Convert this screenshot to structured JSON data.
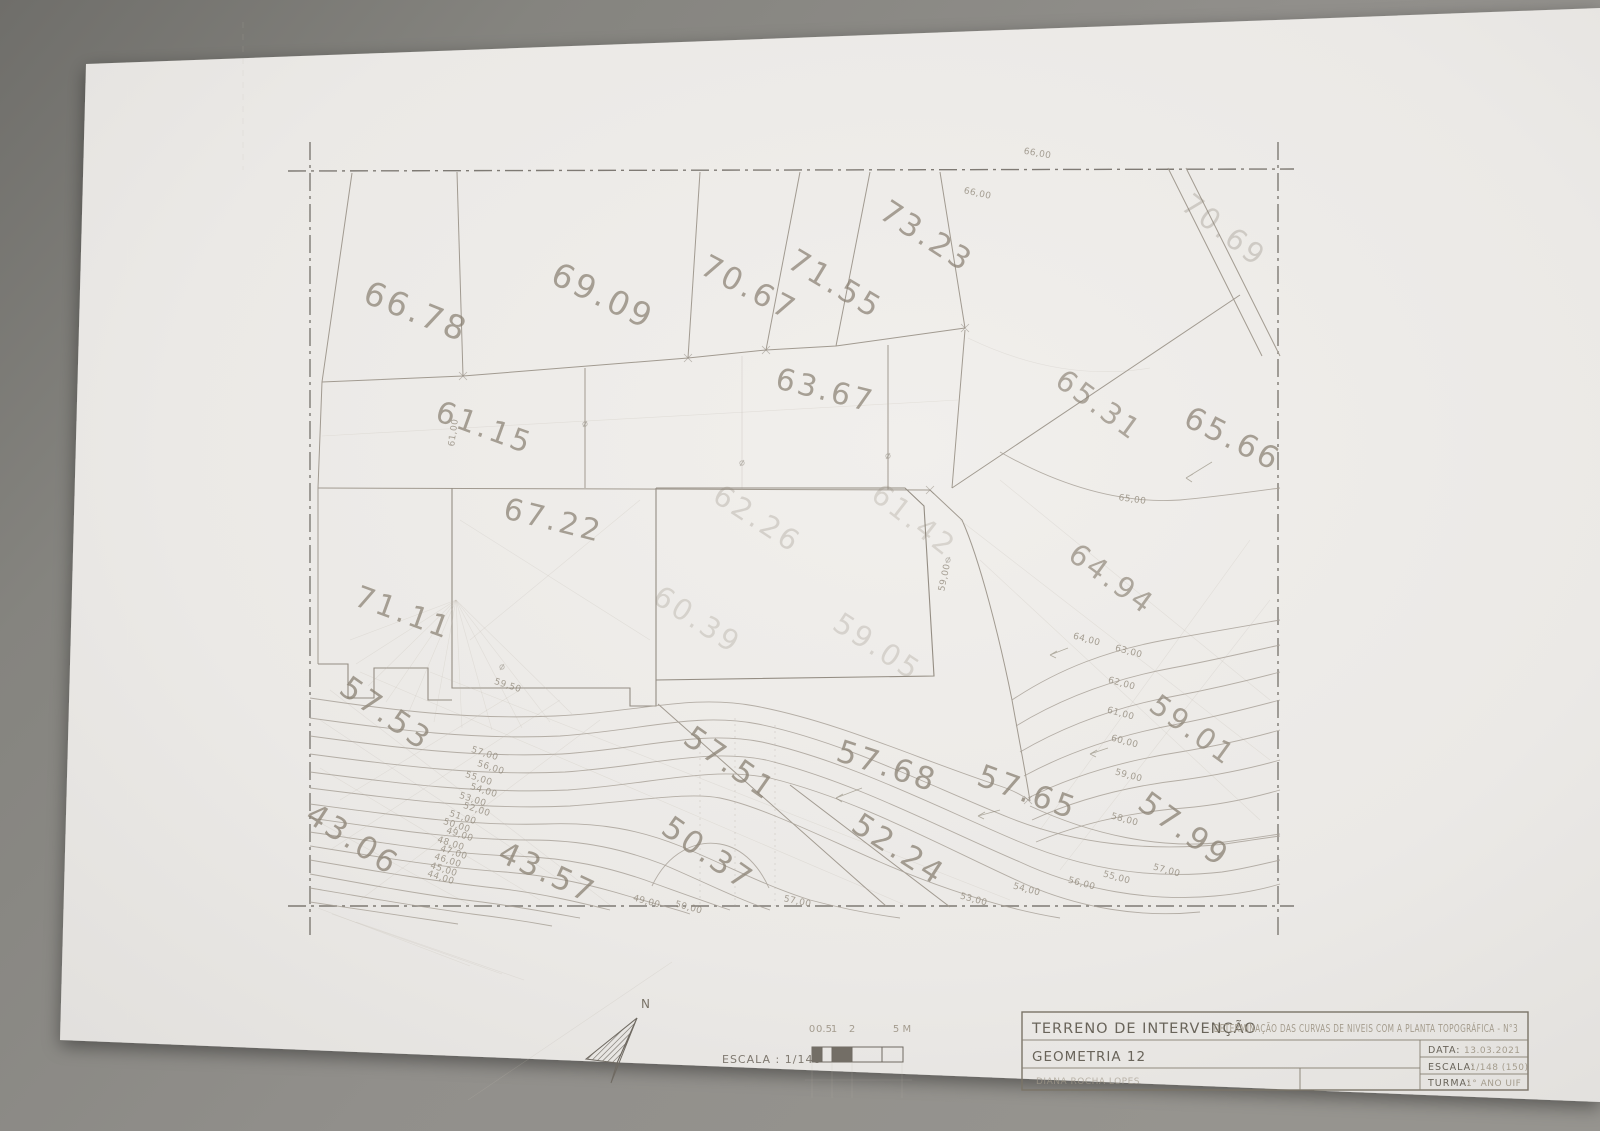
{
  "photo": {
    "backdrop_color": "#8c8b89",
    "paper_color": "#edebe9",
    "pencil_color": "#a19a90"
  },
  "plan": {
    "north_label": "N",
    "parcel_labels": [
      "66.78",
      "69.09",
      "70.67",
      "71.55",
      "73.23",
      "70.69",
      "65.31",
      "65.66",
      "61.15",
      "63.67",
      "67.22",
      "71.11",
      "62.26",
      "61.42",
      "60.39",
      "59.05",
      "64.94",
      "59.01",
      "57.99",
      "57.65",
      "57.68",
      "57.51",
      "52.24",
      "50.37",
      "43.57",
      "43.06",
      "57.53"
    ],
    "contour_labels": [
      "59,50",
      "57,00",
      "56,00",
      "55,00",
      "54,00",
      "53,00",
      "52,00",
      "51,00",
      "50,00",
      "49,00",
      "48,00",
      "47,00",
      "46,00",
      "45,00",
      "44,00",
      "66,00",
      "66,00",
      "65,00",
      "64,00",
      "63,00",
      "62,00",
      "61,00",
      "60,00",
      "59,00",
      "58,00",
      "57,00",
      "56,00",
      "55,00",
      "54,00",
      "53,00",
      "61,00",
      "59,00",
      "49,00",
      "50,00",
      "57,00"
    ]
  },
  "scale_bar": {
    "caption": "ESCALA : 1/148",
    "ticks": [
      "0",
      "0.5",
      "1",
      "2",
      "5 M"
    ]
  },
  "title_block": {
    "project_title": "TERRENO DE INTERVENÇÃO",
    "project_subtitle": "- DETERMINAÇÃO DAS CURVAS DE NIVEIS COM A PLANTA TOPOGRÁFICA - N°3",
    "course": "GEOMETRIA 12",
    "author": "DIANA ROCHA LOPES",
    "date_label": "DATA:",
    "date_value": "13.03.2021",
    "scale_label": "ESCALA:",
    "scale_value": "1/148 (150)",
    "class_label": "TURMA:",
    "class_value": "1° ANO UIF"
  }
}
